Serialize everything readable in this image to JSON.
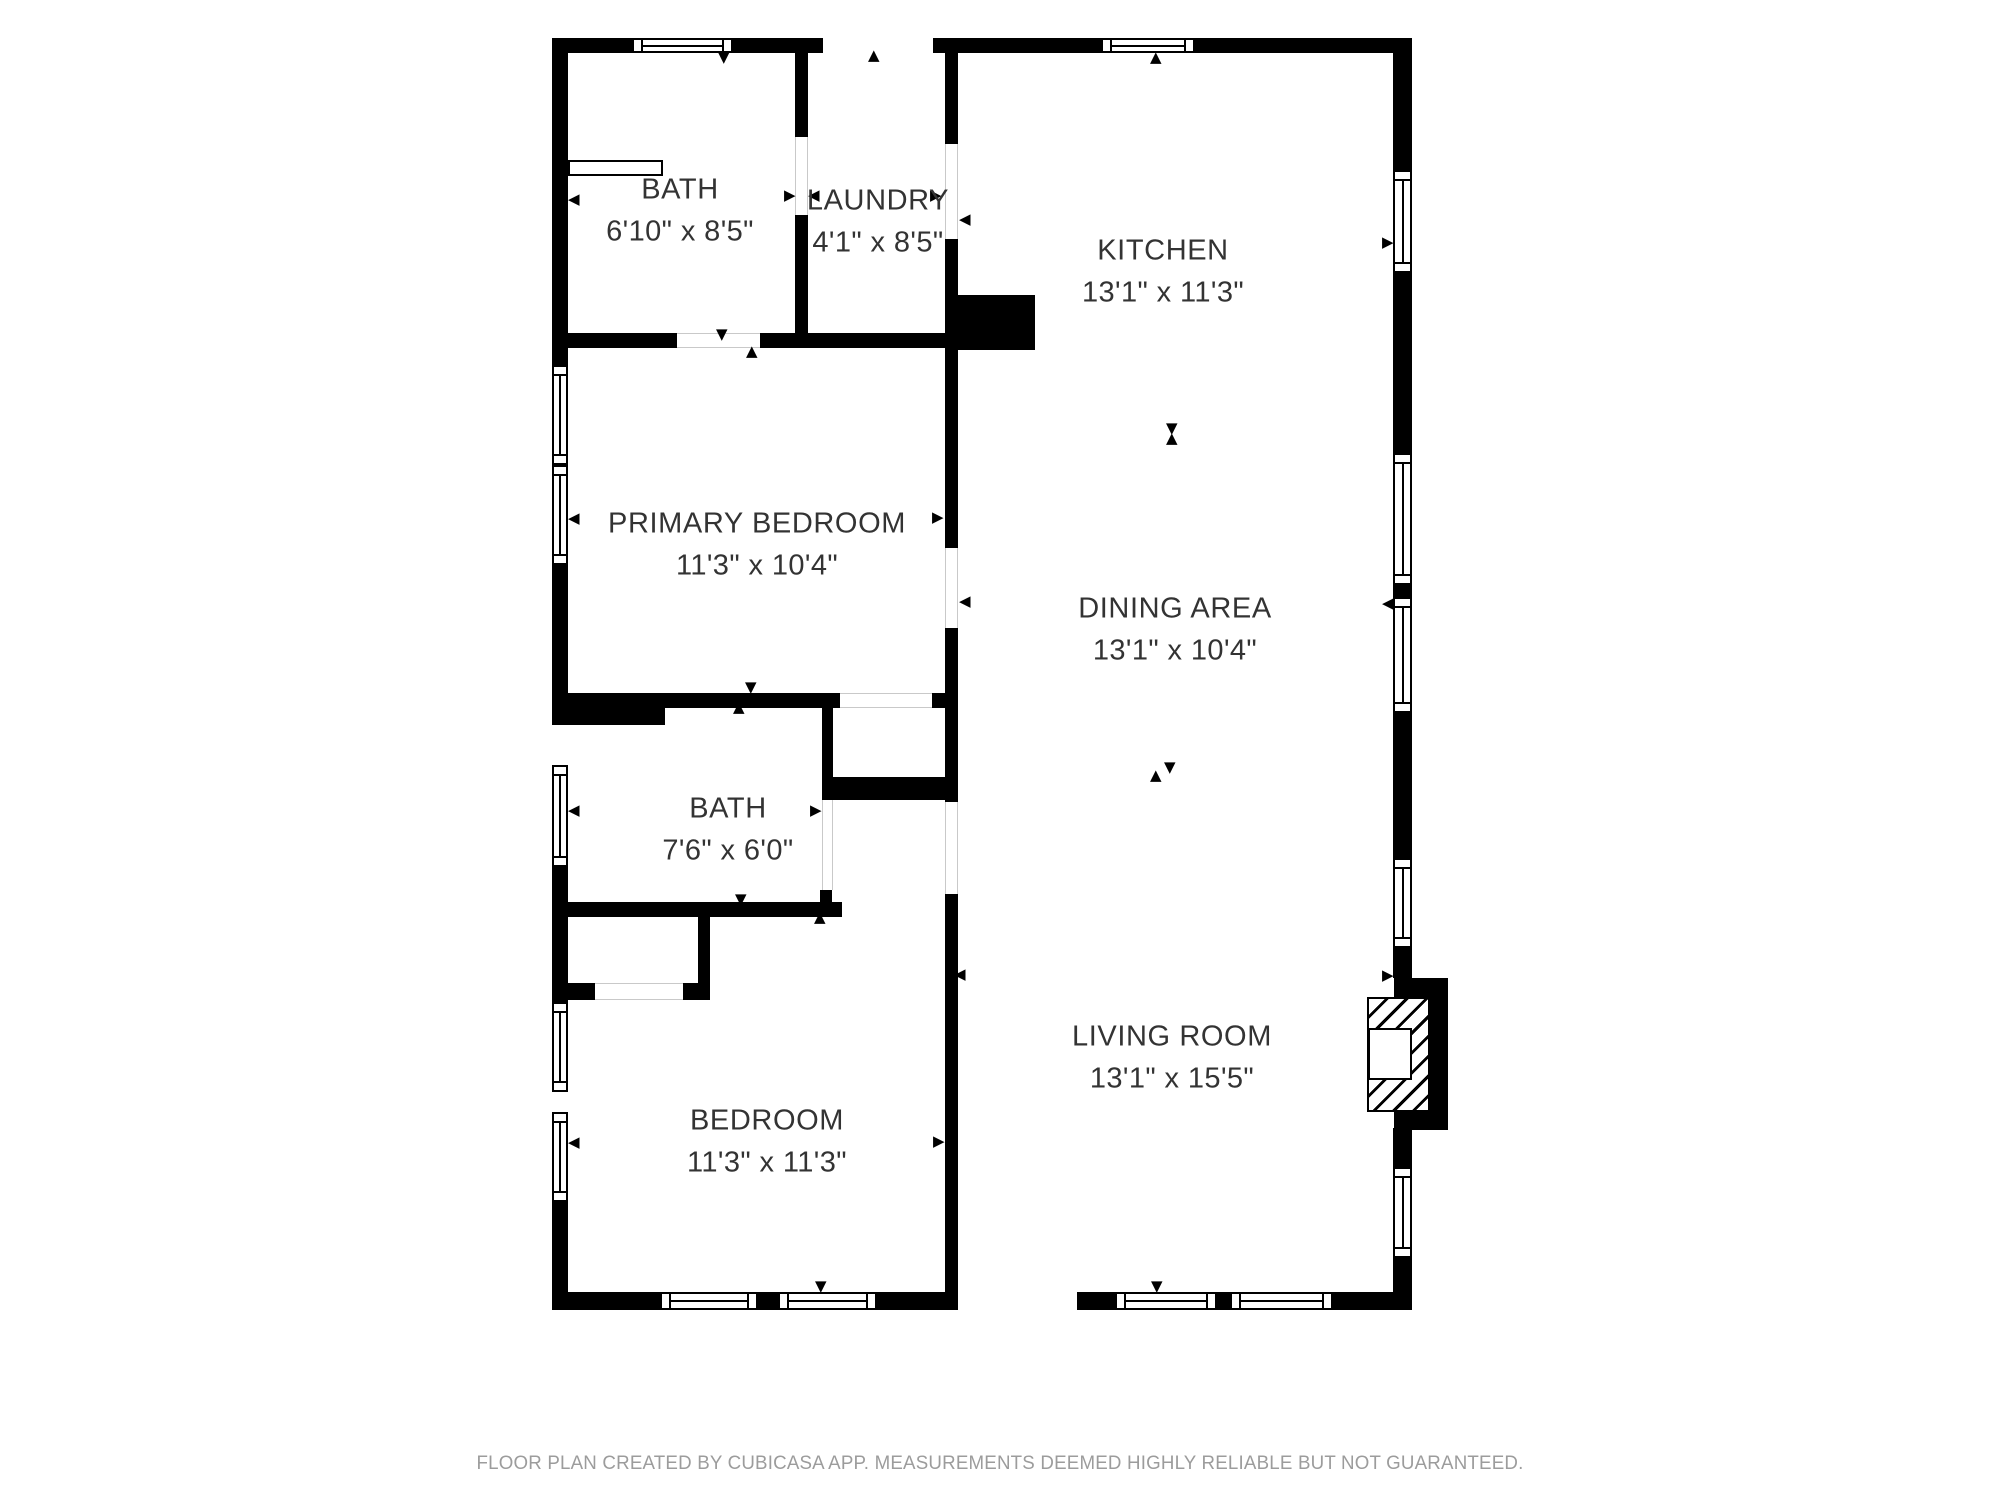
{
  "floor_plan": {
    "rooms": [
      {
        "id": "bath-1",
        "name": "BATH",
        "dims": "6'10\" x 8'5\""
      },
      {
        "id": "laundry",
        "name": "LAUNDRY",
        "dims": "4'1\" x 8'5\""
      },
      {
        "id": "kitchen",
        "name": "KITCHEN",
        "dims": "13'1\" x 11'3\""
      },
      {
        "id": "primary-bedroom",
        "name": "PRIMARY BEDROOM",
        "dims": "11'3\" x 10'4\""
      },
      {
        "id": "dining-area",
        "name": "DINING AREA",
        "dims": "13'1\" x 10'4\""
      },
      {
        "id": "bath-2",
        "name": "BATH",
        "dims": "7'6\" x 6'0\""
      },
      {
        "id": "bedroom",
        "name": "BEDROOM",
        "dims": "11'3\" x 11'3\""
      },
      {
        "id": "living-room",
        "name": "LIVING ROOM",
        "dims": "13'1\" x 15'5\""
      }
    ],
    "footer": {
      "text": "FLOOR PLAN CREATED BY CUBICASA APP. MEASUREMENTS DEEMED HIGHLY RELIABLE BUT NOT GUARANTEED."
    },
    "icons": {
      "arrow-up": "▲",
      "arrow-down": "▼",
      "arrow-left": "◀",
      "arrow-right": "▶"
    },
    "colors": {
      "wall": "#000000",
      "background": "#ffffff",
      "label_text": "#333333",
      "footer_text": "#9c9c9c"
    }
  }
}
